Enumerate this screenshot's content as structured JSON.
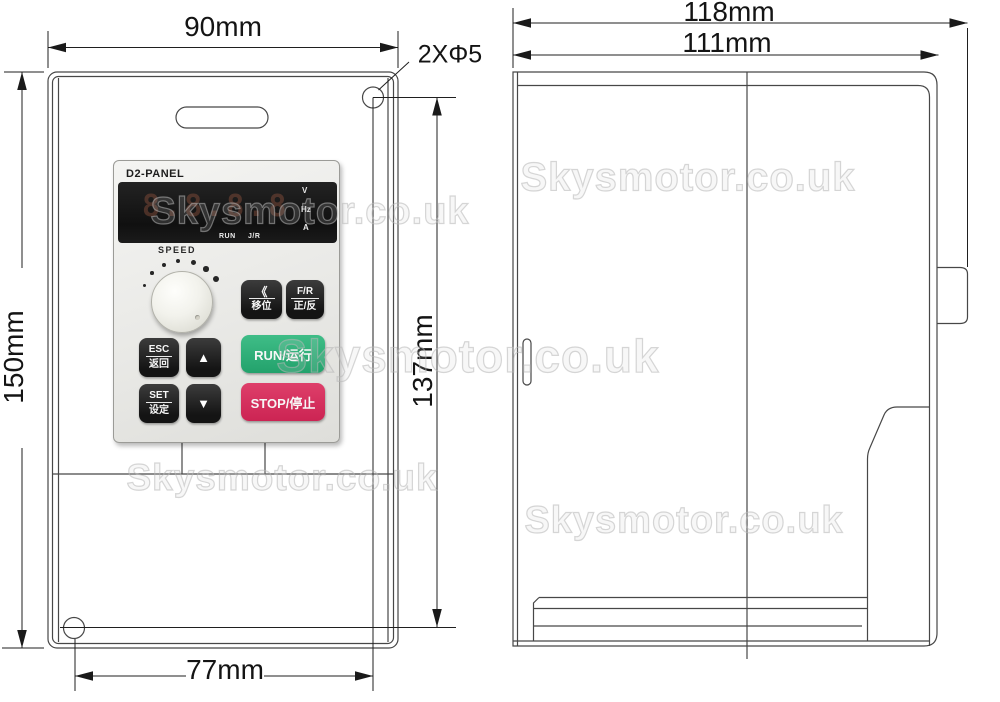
{
  "watermark": {
    "text": "Skysmotor.co.uk"
  },
  "front_view": {
    "dims": {
      "width": "90mm",
      "height": "150mm",
      "hole_spacing_v": "137mm",
      "hole_spacing_h": "77mm",
      "hole_callout": "2XΦ5"
    },
    "panel": {
      "model": "D2-PANEL",
      "display_value": "8.8.8.8",
      "unit_labels": [
        "V",
        "Hz",
        "A"
      ],
      "status_labels": [
        "RUN",
        "J/R"
      ],
      "speed_label": "SPEED",
      "buttons": {
        "shift_top": "《",
        "shift_bottom": "移位",
        "fr_top": "F/R",
        "fr_bottom": "正/反",
        "esc_top": "ESC",
        "esc_bottom": "返回",
        "set_top": "SET",
        "set_bottom": "设定",
        "up": "▲",
        "down": "▼",
        "run": "RUN/运行",
        "stop": "STOP/停止"
      }
    }
  },
  "side_view": {
    "dims": {
      "overall_width": "118mm",
      "body_width": "111mm"
    }
  },
  "colors": {
    "run_green": "#2eb57c",
    "stop_red": "#d32a5b",
    "button_black": "#1c1c1c",
    "panel_gray": "#ececea",
    "line": "#474747"
  }
}
